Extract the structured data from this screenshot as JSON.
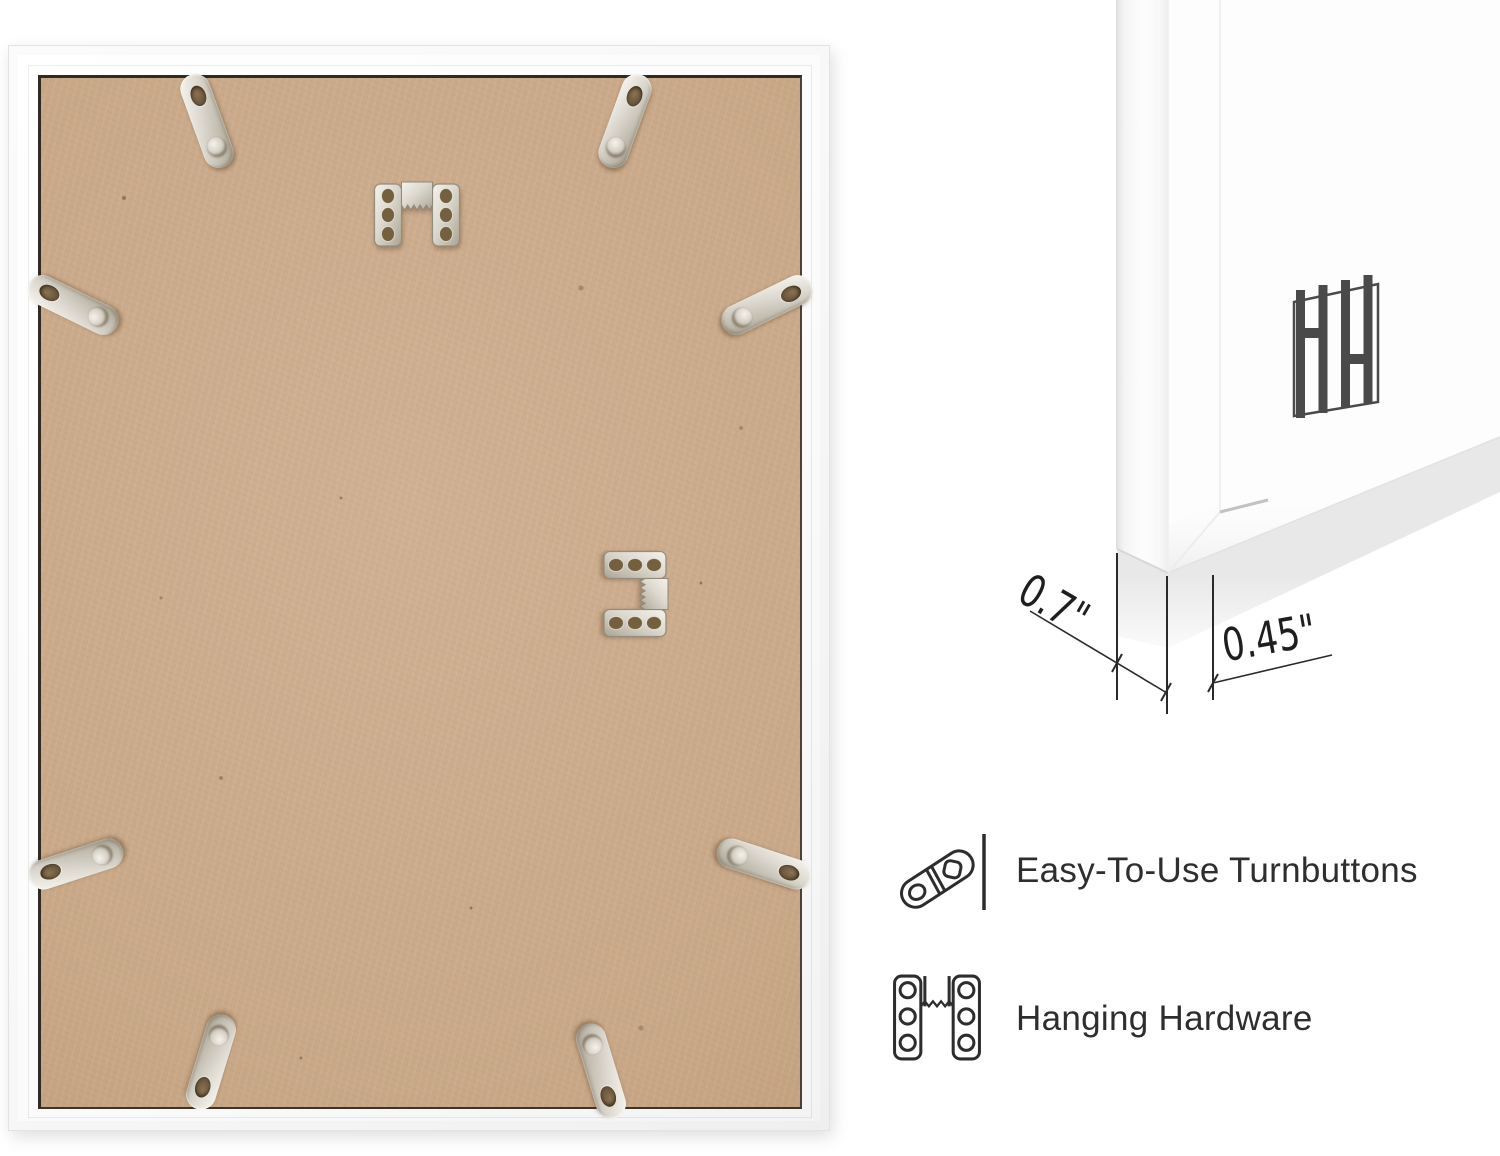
{
  "measurements": {
    "depth": "0.7\"",
    "face_width": "0.45\""
  },
  "features": [
    {
      "icon": "turnbutton-icon",
      "label": "Easy-To-Use Turnbuttons"
    },
    {
      "icon": "hanging-hardware-icon",
      "label": "Hanging Hardware"
    }
  ],
  "brand": {
    "monogram": "HH"
  },
  "scene": {
    "left_photo": "frame-back-photo",
    "right_photo": "frame-corner-photo",
    "turnbutton_count": 8,
    "sawtooth_hanger_count": 2
  },
  "colors": {
    "board": "#c9a888",
    "frame_white": "#fcfcfc",
    "metal": "#d8d4ca",
    "ink": "#2d2d2d",
    "logo_gray": "#4a4a4a",
    "background": "#ffffff"
  }
}
